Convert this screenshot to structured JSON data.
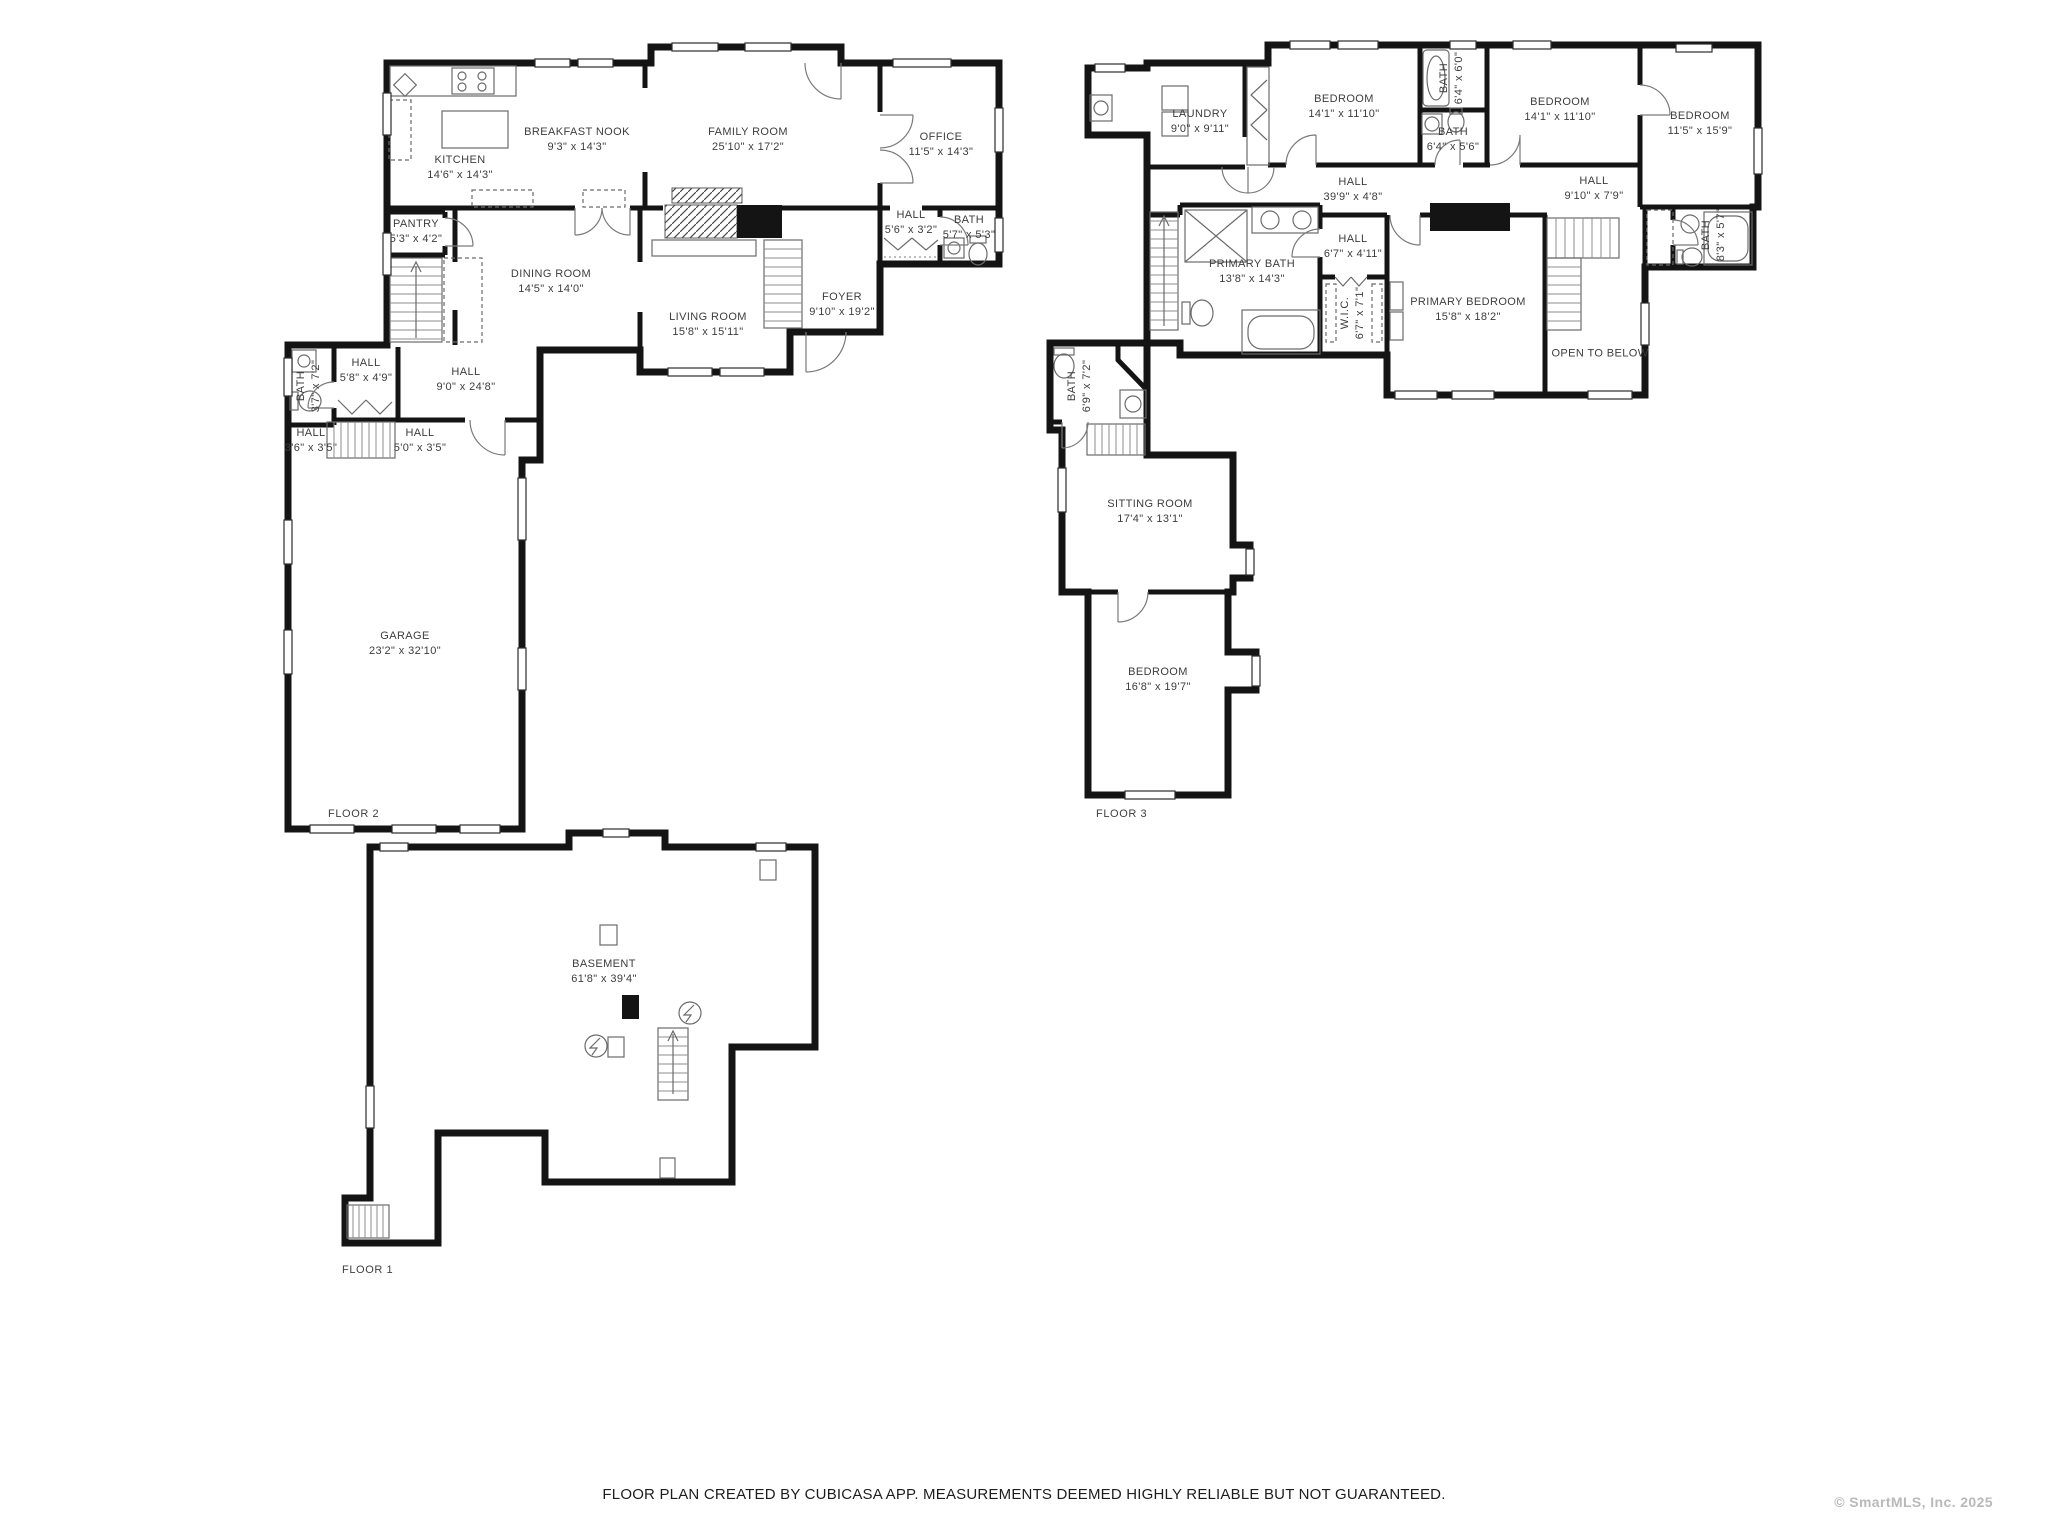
{
  "page": {
    "footer": "FLOOR PLAN CREATED BY CUBICASA APP. MEASUREMENTS DEEMED HIGHLY RELIABLE BUT NOT GUARANTEED.",
    "watermark": "© SmartMLS, Inc. 2025",
    "colors": {
      "wall": "#141414",
      "fixture_line": "#6b6b6b",
      "label_text": "#3d3d3d",
      "watermark_text": "#b9b9b9"
    }
  },
  "floors": [
    {
      "label": "FLOOR 2",
      "rooms": [
        {
          "name": "KITCHEN",
          "dims": "14'6\" x 14'3\""
        },
        {
          "name": "BREAKFAST NOOK",
          "dims": "9'3\" x 14'3\""
        },
        {
          "name": "FAMILY ROOM",
          "dims": "25'10\" x 17'2\""
        },
        {
          "name": "OFFICE",
          "dims": "11'5\" x 14'3\""
        },
        {
          "name": "PANTRY",
          "dims": "5'3\" x 4'2\""
        },
        {
          "name": "DINING ROOM",
          "dims": "14'5\" x 14'0\""
        },
        {
          "name": "LIVING ROOM",
          "dims": "15'8\" x 15'11\""
        },
        {
          "name": "FOYER",
          "dims": "9'10\" x 19'2\""
        },
        {
          "name": "HALL",
          "dims": "5'6\" x 3'2\""
        },
        {
          "name": "BATH",
          "dims": "5'7\" x 5'3\""
        },
        {
          "name": "BATH",
          "dims": "3'7\" x 7'2\""
        },
        {
          "name": "HALL",
          "dims": "5'8\" x 4'9\""
        },
        {
          "name": "HALL",
          "dims": "9'0\" x 24'8\""
        },
        {
          "name": "HALL",
          "dims": "3'6\" x 3'5\""
        },
        {
          "name": "HALL",
          "dims": "5'0\" x 3'5\""
        },
        {
          "name": "GARAGE",
          "dims": "23'2\" x 32'10\""
        }
      ]
    },
    {
      "label": "FLOOR 3",
      "rooms": [
        {
          "name": "LAUNDRY",
          "dims": "9'0\" x 9'11\""
        },
        {
          "name": "BEDROOM",
          "dims": "14'1\" x 11'10\""
        },
        {
          "name": "BATH",
          "dims": "6'4\" x 6'0\""
        },
        {
          "name": "BATH",
          "dims": "6'4\" x 5'6\""
        },
        {
          "name": "BEDROOM",
          "dims": "14'1\" x 11'10\""
        },
        {
          "name": "BEDROOM",
          "dims": "11'5\" x 15'9\""
        },
        {
          "name": "HALL",
          "dims": "39'9\" x 4'8\""
        },
        {
          "name": "HALL",
          "dims": "9'10\" x 7'9\""
        },
        {
          "name": "BATH",
          "dims": "8'3\" x 5'7\""
        },
        {
          "name": "PRIMARY BATH",
          "dims": "13'8\" x 14'3\""
        },
        {
          "name": "HALL",
          "dims": "6'7\" x 4'11\""
        },
        {
          "name": "W.I.C.",
          "dims": "6'7\" x 7'1\""
        },
        {
          "name": "PRIMARY BEDROOM",
          "dims": "15'8\" x 18'2\""
        },
        {
          "name": "OPEN TO BELOW",
          "dims": ""
        },
        {
          "name": "BATH",
          "dims": "6'9\" x 7'2\""
        },
        {
          "name": "SITTING ROOM",
          "dims": "17'4\" x 13'1\""
        },
        {
          "name": "BEDROOM",
          "dims": "16'8\" x 19'7\""
        }
      ]
    },
    {
      "label": "FLOOR 1",
      "rooms": [
        {
          "name": "BASEMENT",
          "dims": "61'8\" x 39'4\""
        }
      ]
    }
  ]
}
